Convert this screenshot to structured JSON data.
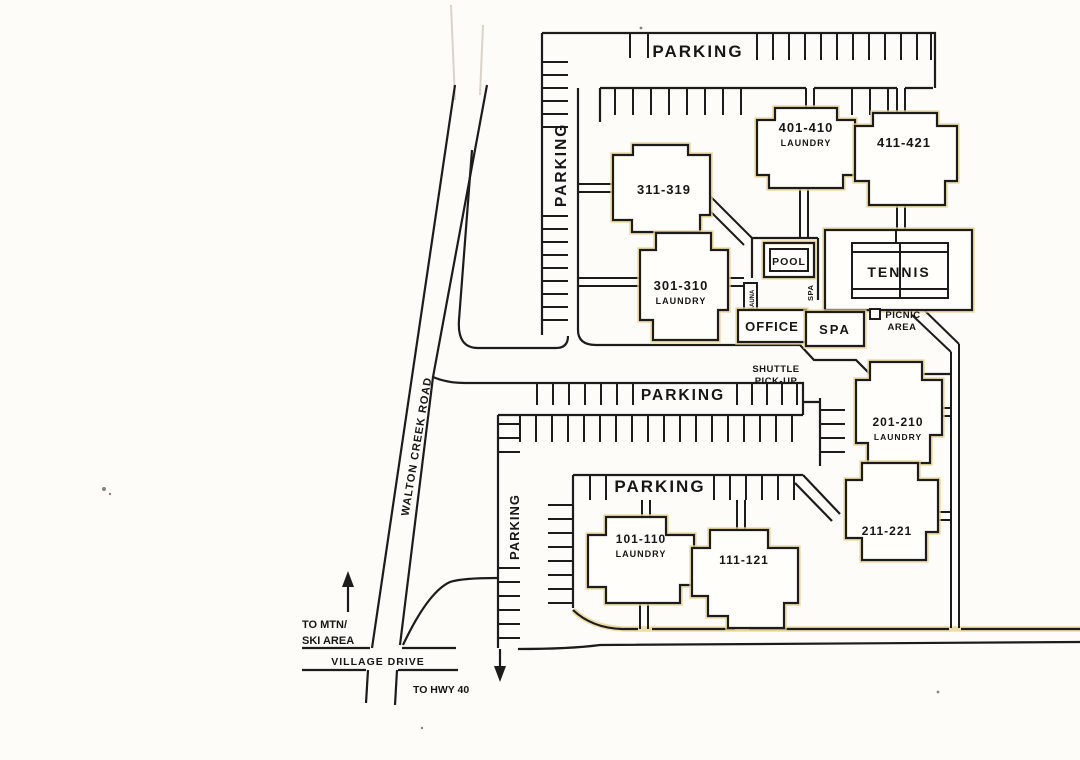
{
  "map_type": "resort-site-plan",
  "labels": {
    "parking_top": "PARKING",
    "parking_left": "PARKING",
    "parking_middle": "PARKING",
    "parking_lower": "PARKING",
    "parking_bottom_left": "PARKING"
  },
  "buildings": [
    {
      "label": "311-319",
      "laundry": ""
    },
    {
      "label": "401-410",
      "laundry": "LAUNDRY"
    },
    {
      "label": "411-421",
      "laundry": ""
    },
    {
      "label": "301-310",
      "laundry": "LAUNDRY"
    },
    {
      "label": "201-210",
      "laundry": "LAUNDRY"
    },
    {
      "label": "211-221",
      "laundry": ""
    },
    {
      "label": "101-110",
      "laundry": "LAUNDRY"
    },
    {
      "label": "111-121",
      "laundry": ""
    }
  ],
  "amenities": {
    "pool": "POOL",
    "tennis": "TENNIS",
    "office": "OFFICE",
    "spa": "SPA",
    "spa_walk": "SPA",
    "sauna": "SAUNA",
    "picnic_line1": "PICNIC",
    "picnic_line2": "AREA",
    "shuttle_line1": "SHUTTLE",
    "shuttle_line2": "PICK-UP"
  },
  "roads": {
    "walton_creek": "WALTON CREEK ROAD",
    "village_drive": "VILLAGE DRIVE",
    "to_mtn_line1": "TO MTN/",
    "to_mtn_line2": "SKI AREA",
    "to_hwy": "TO HWY 40"
  },
  "colors": {
    "ink": "#1e1c1a",
    "paper": "#fdfcf8",
    "scan_tint": "#e7d493"
  }
}
